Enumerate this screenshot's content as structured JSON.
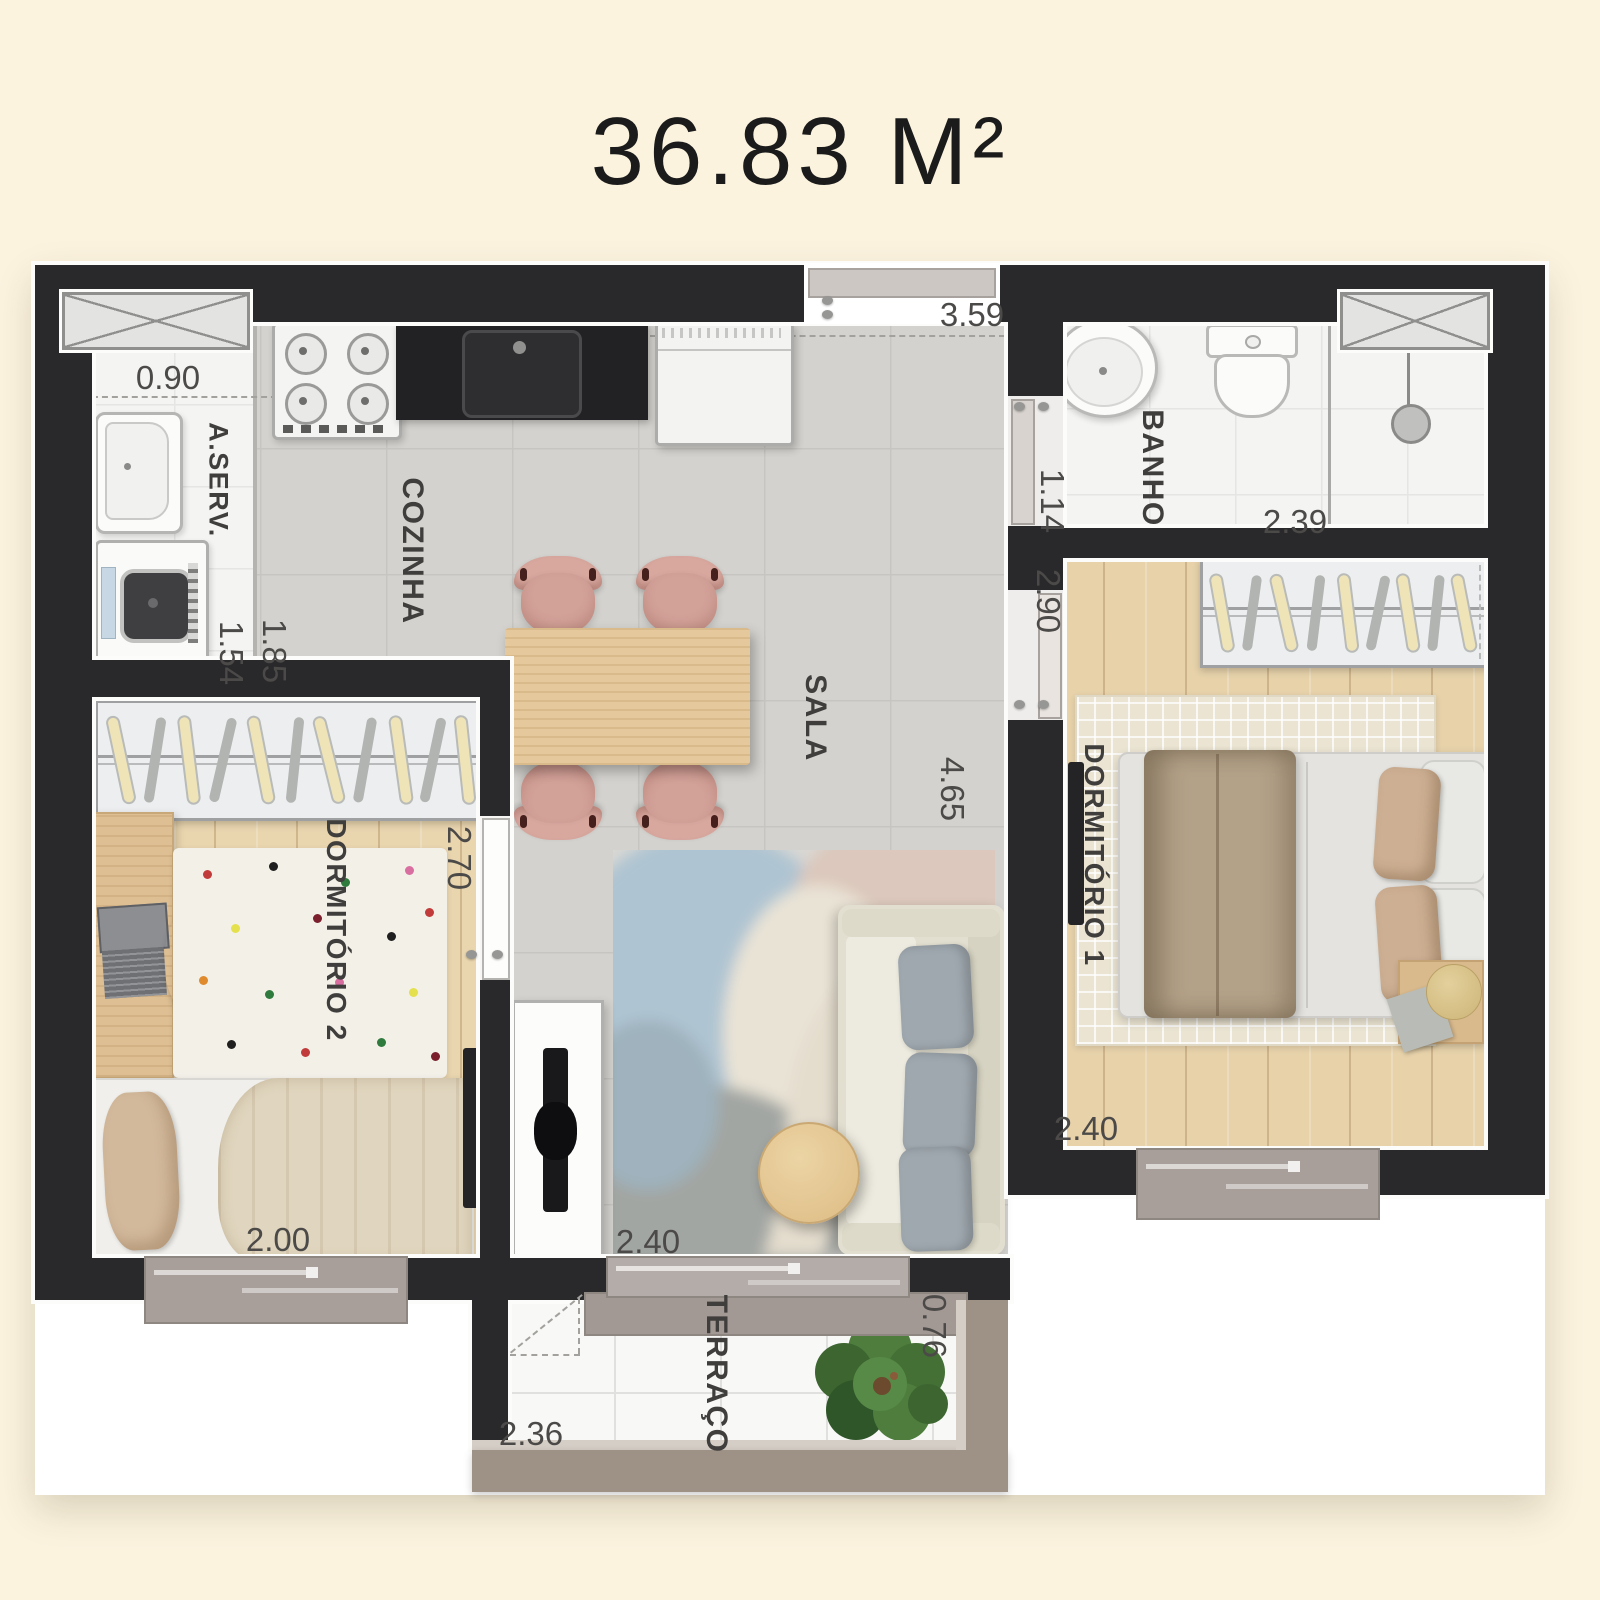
{
  "title": "36.83 M²",
  "plan": {
    "rooms": [
      {
        "id": "aserv",
        "label": "A.SERV."
      },
      {
        "id": "cozinha",
        "label": "COZINHA"
      },
      {
        "id": "sala",
        "label": "SALA"
      },
      {
        "id": "banho",
        "label": "BANHO"
      },
      {
        "id": "dormitorio1",
        "label": "DORMITÓRIO 1"
      },
      {
        "id": "dormitorio2",
        "label": "DORMITÓRIO 2"
      },
      {
        "id": "terraco",
        "label": "TERRAÇO"
      }
    ],
    "dimensions": [
      {
        "id": "aserv-width",
        "value": "0.90"
      },
      {
        "id": "sala-width",
        "value": "3.59"
      },
      {
        "id": "aserv-depth",
        "value": "1.54"
      },
      {
        "id": "cozinha-width",
        "value": "1.85"
      },
      {
        "id": "banho-width",
        "value": "1.14"
      },
      {
        "id": "banho-depth",
        "value": "2.39"
      },
      {
        "id": "dorm1-depth",
        "value": "2.90"
      },
      {
        "id": "sala-depth",
        "value": "4.65"
      },
      {
        "id": "dorm2-depth",
        "value": "2.70"
      },
      {
        "id": "dorm1-width",
        "value": "2.40"
      },
      {
        "id": "dorm2-width",
        "value": "2.00"
      },
      {
        "id": "sala-door-width",
        "value": "2.40"
      },
      {
        "id": "terraco-width",
        "value": "2.36"
      },
      {
        "id": "terraco-depth",
        "value": "0.76"
      }
    ],
    "colors": {
      "background": "#FBF3DE",
      "wall": "#29292B",
      "tile_gray": "#D4D2CE",
      "tile_white": "#F4F4F2",
      "wood": "#E7D2AA",
      "chair_pink": "#D8A89F",
      "plant_green": "#4F7D3E",
      "railing": "#9E9287"
    }
  }
}
